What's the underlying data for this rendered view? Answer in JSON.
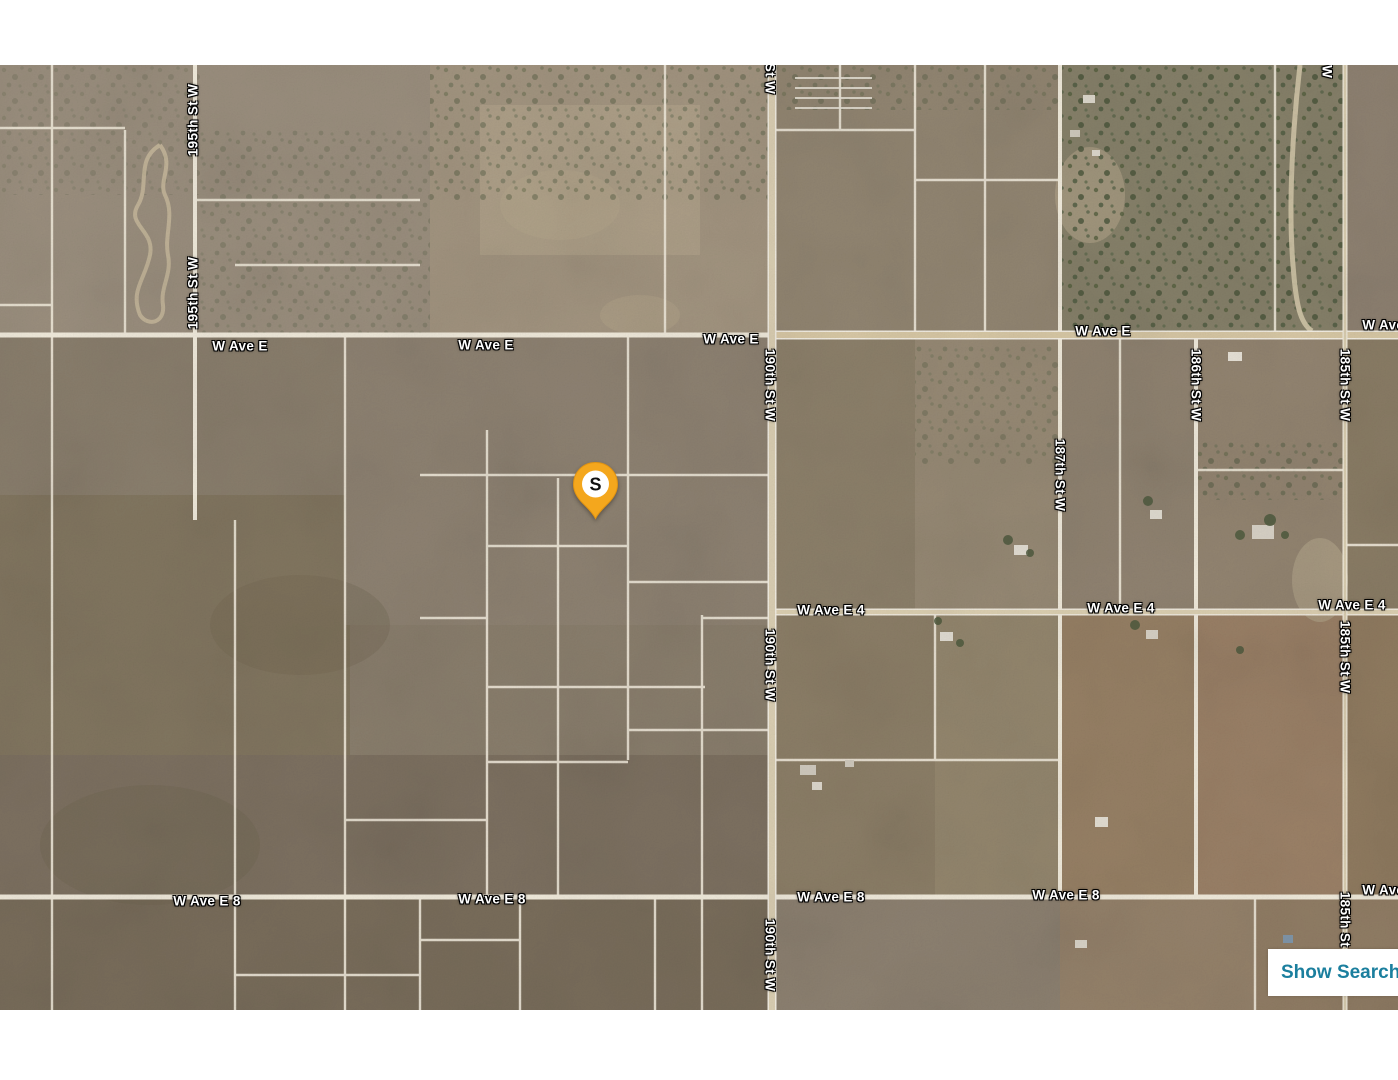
{
  "map": {
    "road_labels": {
      "ave_e": "W Ave E",
      "ave_e4": "W Ave E 4",
      "ave_e8": "W Ave E 8",
      "st_185": "185th St W",
      "st_186": "186th St W",
      "st_187": "187th St W",
      "st_190": "190th St W",
      "st_195": "195th St W"
    },
    "marker": {
      "label": "S",
      "fill": "#F4A71D"
    }
  },
  "controls": {
    "show_search": {
      "label": "Show Search",
      "text_color": "#1B7F9E",
      "background": "#FFFFFF"
    }
  },
  "colors": {
    "label_text": "#FFFFFF",
    "road_fill": "#DCCFB3",
    "parcel_line": "#EDE6D7"
  }
}
